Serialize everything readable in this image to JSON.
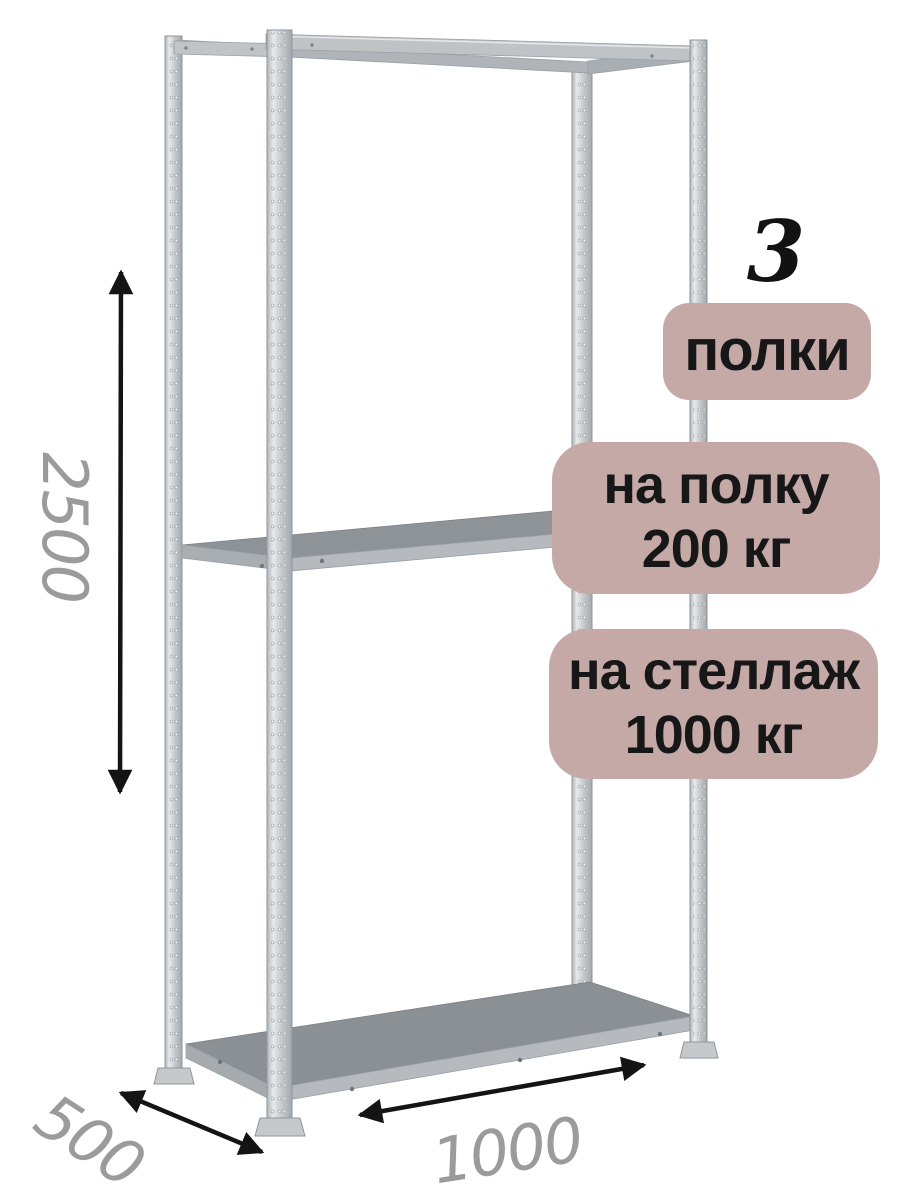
{
  "annotations": {
    "shelf_count": "3",
    "badge_shelves": "полки",
    "badge_per_shelf": {
      "line1": "на полку",
      "line2": "200 кг"
    },
    "badge_per_rack": {
      "line1": "на стеллаж",
      "line2": "1000 кг"
    }
  },
  "dimensions": {
    "height_mm": "2500",
    "depth_mm": "500",
    "width_mm": "1000"
  },
  "colors": {
    "background": "#ffffff",
    "badge_bg": "#c5a9a7",
    "badge_text": "#171717",
    "dimension_text": "#9b9b9b",
    "arrow": "#141414",
    "metal_light": "#dfe1e3",
    "metal_mid": "#bfc3c6",
    "shelf_top": "#8b9094"
  }
}
